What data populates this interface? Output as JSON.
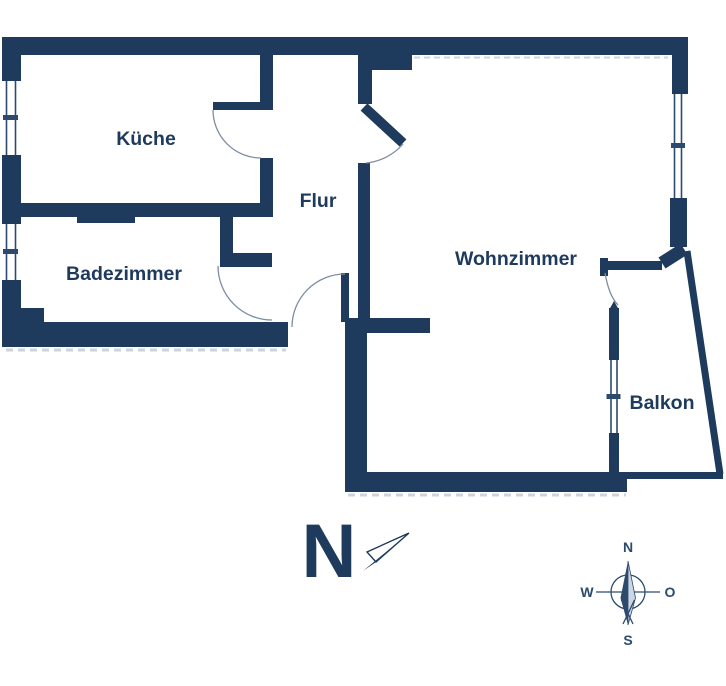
{
  "palette": {
    "wall": "#1e3a5c",
    "line": "#2c4a6e",
    "arc": "#7d8da3",
    "shadow": "#ccd4de",
    "text": "#1e3a5c",
    "needle_light": "#ccd6e2"
  },
  "rooms": [
    {
      "id": "kueche",
      "label": "Küche"
    },
    {
      "id": "flur",
      "label": "Flur"
    },
    {
      "id": "badezimmer",
      "label": "Badezimmer"
    },
    {
      "id": "wohnzimmer",
      "label": "Wohnzimmer"
    },
    {
      "id": "balkon",
      "label": "Balkon"
    }
  ],
  "north_indicator": {
    "letter": "N"
  },
  "compass": {
    "north": "N",
    "east": "O",
    "south": "S",
    "west": "W"
  }
}
